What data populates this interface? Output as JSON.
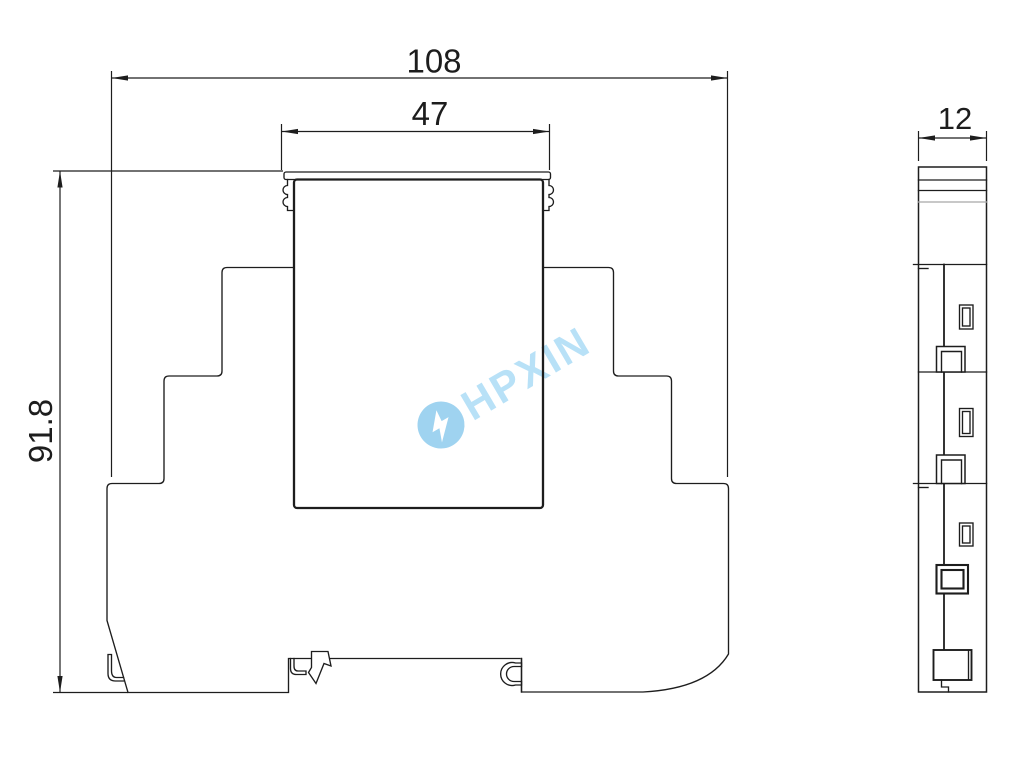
{
  "drawing": {
    "title": "DIN-rail module outline drawing",
    "front_view": {
      "width_label": "108",
      "cap_width_label": "47",
      "height_label": "91.8"
    },
    "side_view": {
      "width_label": "12"
    },
    "watermark": {
      "text": "HPXIN"
    },
    "colors": {
      "line": "#1d1d1d",
      "gray_line": "#a8a8a8",
      "watermark_text": "#b8e1f7",
      "watermark_logo": "#9fd3f0",
      "background": "#ffffff"
    }
  }
}
